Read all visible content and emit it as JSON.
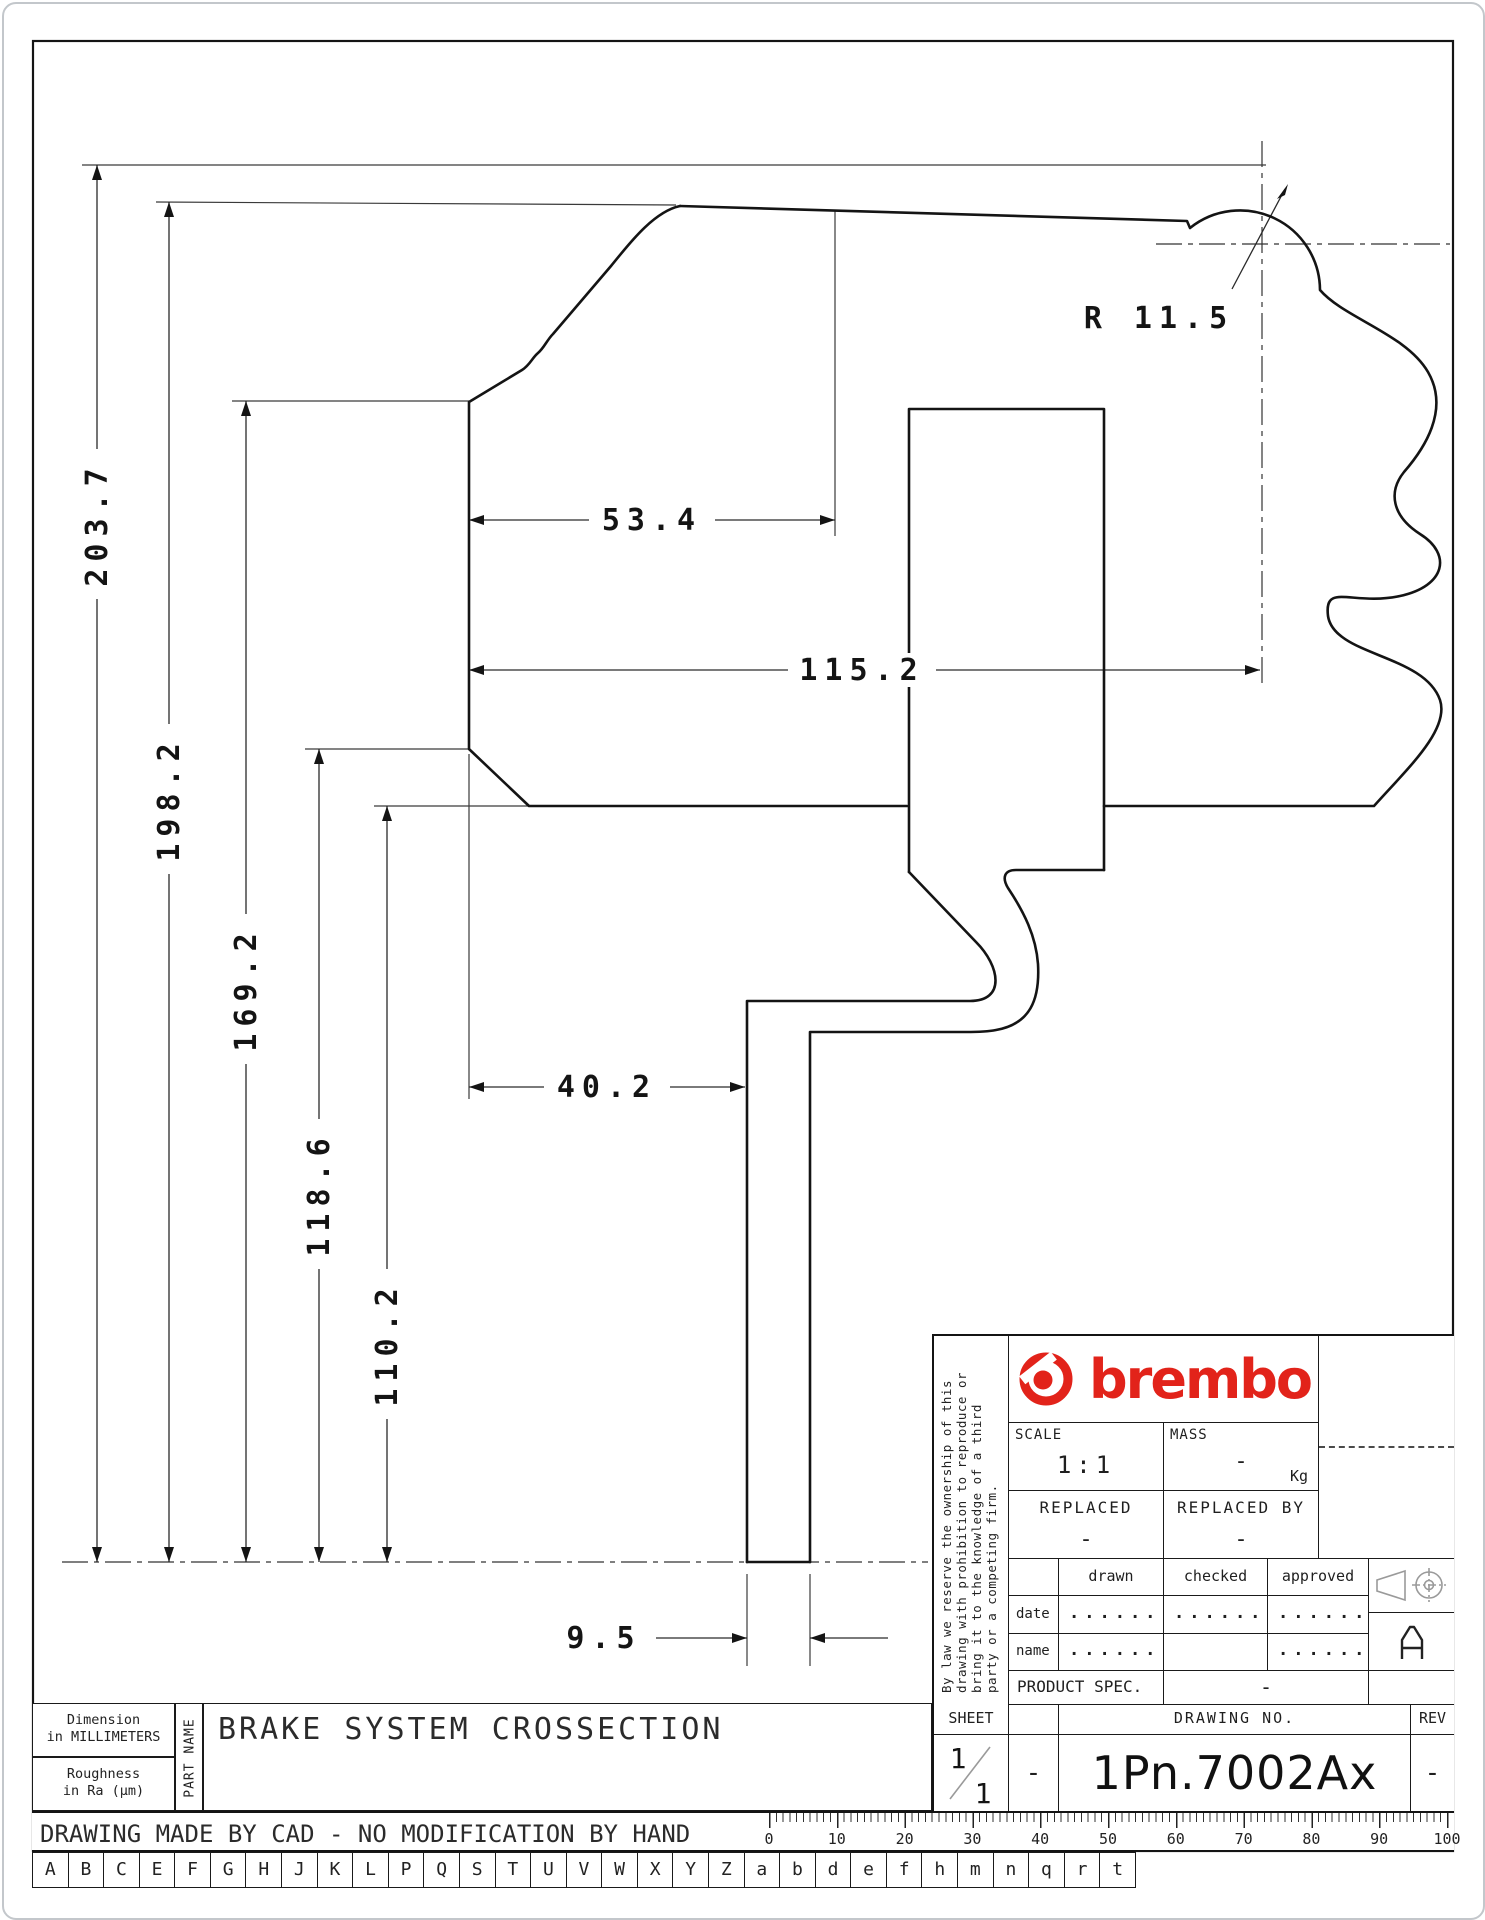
{
  "drawing": {
    "radius_label": "R 11.5",
    "vertical_dims": [
      "203.7",
      "198.2",
      "169.2",
      "118.6",
      "110.2"
    ],
    "horizontal_dims": [
      "53.4",
      "115.2",
      "40.2",
      "9.5"
    ]
  },
  "title_block": {
    "brand": "brembo",
    "disclaimer_lines": [
      "By law we reserve the ownership of this",
      "drawing with prohibition to reproduce or",
      "bring it to the knowledge of a third",
      "party or a competing firm."
    ],
    "scale_label": "SCALE",
    "scale_value": "1:1",
    "mass_label": "MASS",
    "mass_value": "-",
    "mass_unit": "Kg",
    "replaced_label": "REPLACED",
    "replaced_value": "-",
    "replaced_by_label": "REPLACED BY",
    "replaced_by_value": "-",
    "sign_cols": [
      "drawn",
      "checked",
      "approved"
    ],
    "date_label": "date",
    "name_label": "name",
    "date_dots": [
      "........",
      "........",
      "........"
    ],
    "name_dots": [
      "........",
      "",
      "........"
    ],
    "product_spec_label": "PRODUCT SPEC.",
    "product_spec_value": "-",
    "sheet_label": "SHEET",
    "sheet_num": "1",
    "sheet_den": "1",
    "sheet_dash": "-",
    "drawing_no_label": "DRAWING NO.",
    "drawing_no": "1Pn.7002Ax",
    "rev_label": "REV",
    "rev_value": "-",
    "size_letter": "A"
  },
  "footer": {
    "dimension_note_1": "Dimension",
    "dimension_note_2": "in MILLIMETERS",
    "roughness_note_1": "Roughness",
    "roughness_note_2": "in Ra (µm)",
    "part_name_label": "PART NAME",
    "part_name": "BRAKE SYSTEM CROSSECTION",
    "cad_note": "DRAWING MADE BY CAD - NO MODIFICATION BY HAND",
    "ruler_labels": [
      "0",
      "10",
      "20",
      "30",
      "40",
      "50",
      "60",
      "70",
      "80",
      "90",
      "100"
    ],
    "letters": [
      "A",
      "B",
      "C",
      "E",
      "F",
      "G",
      "H",
      "J",
      "K",
      "L",
      "P",
      "Q",
      "S",
      "T",
      "U",
      "V",
      "W",
      "X",
      "Y",
      "Z",
      "a",
      "b",
      "d",
      "e",
      "f",
      "h",
      "m",
      "n",
      "q",
      "r",
      "t"
    ]
  },
  "colors": {
    "brand_red": "#e2231a",
    "line": "#141414"
  }
}
